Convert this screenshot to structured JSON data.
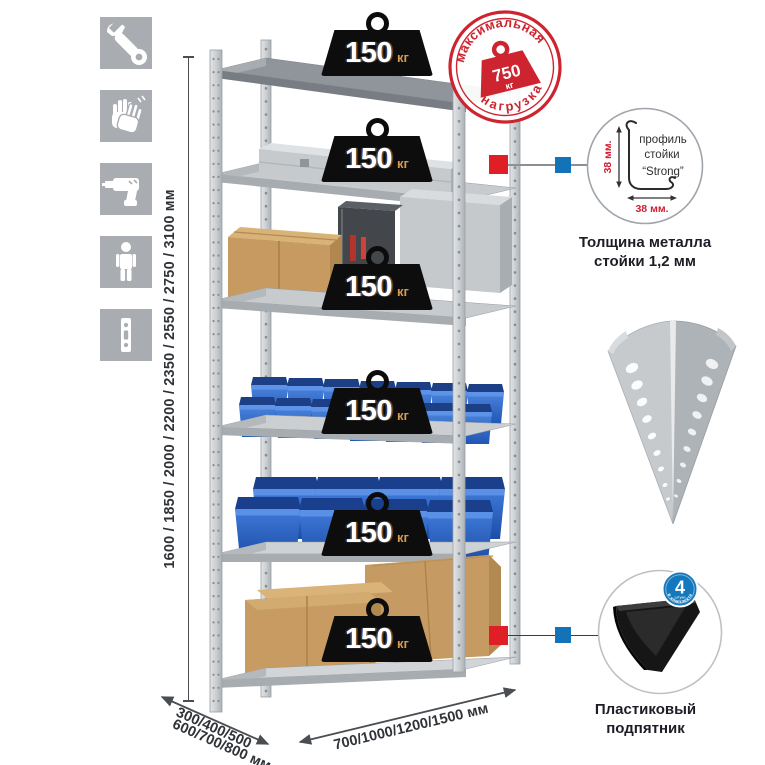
{
  "sidebar": {
    "icons": [
      {
        "name": "wrench"
      },
      {
        "name": "gloves"
      },
      {
        "name": "drill"
      },
      {
        "name": "person-height"
      },
      {
        "name": "perforated-post"
      }
    ]
  },
  "height_dimension": {
    "label": "1600 / 1850 / 2000 / 2200 / 2350 / 2550 / 2750 / 3100 мм"
  },
  "shelf_levels": [
    {
      "load": "150",
      "unit": "кг"
    },
    {
      "load": "150",
      "unit": "кг"
    },
    {
      "load": "150",
      "unit": "кг"
    },
    {
      "load": "150",
      "unit": "кг"
    },
    {
      "load": "150",
      "unit": "кг"
    },
    {
      "load": "150",
      "unit": "кг"
    }
  ],
  "max_load_stamp": {
    "arc_top": "максимальная",
    "arc_bottom": "нагрузка",
    "value": "750",
    "unit": "кг",
    "color": "#ce2430"
  },
  "profile_detail": {
    "label_line1": "профиль",
    "label_line2": "стойки",
    "label_line3": "“Strong”",
    "dim_vertical": "38 мм.",
    "dim_horizontal": "38 мм.",
    "caption_line1": "Толщина металла",
    "caption_line2": "стойки 1,2 мм"
  },
  "foot_detail": {
    "badge_value": "4",
    "badge_small": "штуки",
    "badge_arc": "в комплекте",
    "caption_line1": "Пластиковый",
    "caption_line2": "подпятник",
    "badge_color": "#1478bd"
  },
  "depth_dimension": {
    "line1": "300/400/500",
    "line2": "600/700/800 мм"
  },
  "width_dimension": {
    "label": "700/1000/1200/1500 мм"
  },
  "colors": {
    "accent_red": "#e01e25",
    "accent_blue": "#1472b8",
    "bin_blue": "#2d62c4",
    "metal_gray": "#c7cbce"
  }
}
